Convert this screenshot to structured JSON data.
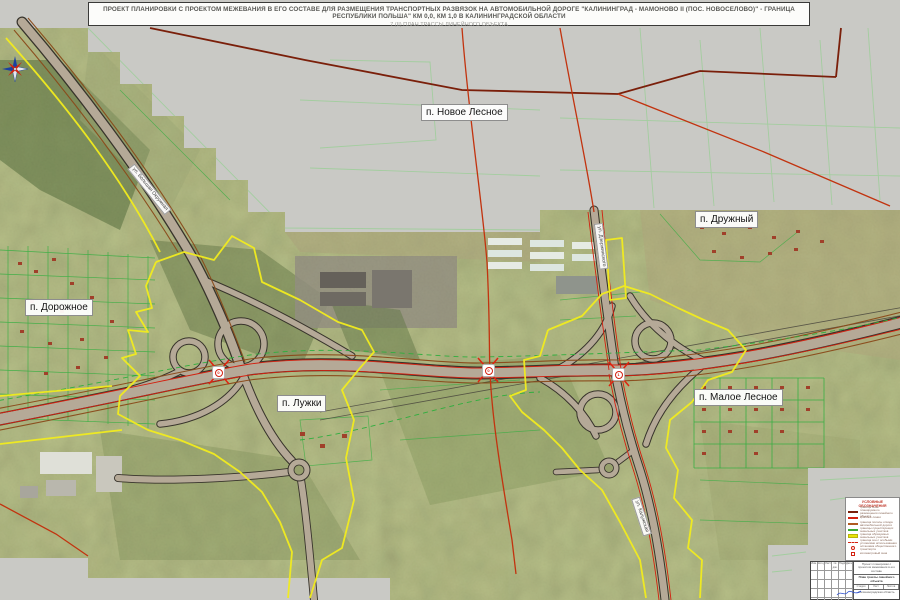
{
  "title": {
    "line1": "ПРОЕКТ ПЛАНИРОВКИ С ПРОЕКТОМ МЕЖЕВАНИЯ В ЕГО СОСТАВЕ ДЛЯ РАЗМЕЩЕНИЯ ТРАНСПОРТНЫХ РАЗВЯЗОК НА АВТОМОБИЛЬНОЙ ДОРОГЕ \"КАЛИНИНГРАД - МАМОНОВО II (ПОС. НОВОСЕЛОВО)\" - ГРАНИЦА РЕСПУБЛИКИ ПОЛЬША\" КМ 0,0, КМ 1,0 В КАЛИНИНГРАДСКОЙ ОБЛАСТИ",
    "line2": "7 (II) ПЛАН ТРАССЫ ЛИНЕЙНОГО ОБЪЕКТА"
  },
  "map": {
    "settlements": [
      {
        "name": "п. Новое Лесное"
      },
      {
        "name": "п. Дружный"
      },
      {
        "name": "п. Дорожное"
      },
      {
        "name": "п. Лужки"
      },
      {
        "name": "п. Малое Лесное"
      }
    ],
    "road_labels": [
      {
        "name": "ул. Большая Окружная"
      },
      {
        "name": "ул. Дзержинского"
      },
      {
        "name": "ул. Калужская"
      }
    ],
    "km_markers": [
      {
        "value": "0"
      },
      {
        "value": "0"
      },
      {
        "value": "1"
      }
    ]
  },
  "legend": {
    "title": "УСЛОВНЫЕ ОБОЗНАЧЕНИЯ",
    "items": [
      {
        "label": "граница зоны планируемого размещения линейного объекта"
      },
      {
        "label": "красные линии"
      },
      {
        "label": "граница полосы отвода автомобильной дороги"
      },
      {
        "label": "границы существующих земельных участков"
      },
      {
        "label": "граница образуемых земельных участков"
      },
      {
        "label": "граница зон с особыми условиями использования"
      },
      {
        "label": "остановка общественного транспорта"
      },
      {
        "label": "километровый знак"
      }
    ]
  },
  "stamp": {
    "cols": [
      "Изм.",
      "Кол.уч.",
      "Лист",
      "№ док.",
      "Подп.",
      "Дата"
    ],
    "note": "Проект планировки с проектом межевания в его составе",
    "doc_title": "План трассы линейного объекта",
    "sheet_labels": [
      "Стадия",
      "Лист",
      "Листов"
    ],
    "org": "Калининградская область"
  },
  "colors": {
    "boundary_yellow": "#f2ec1e",
    "red_line": "#d3200f",
    "dark_red": "#7a1f0a",
    "parcel_green": "#2fae3e",
    "unmapped_gray": "#c9c9c5"
  }
}
